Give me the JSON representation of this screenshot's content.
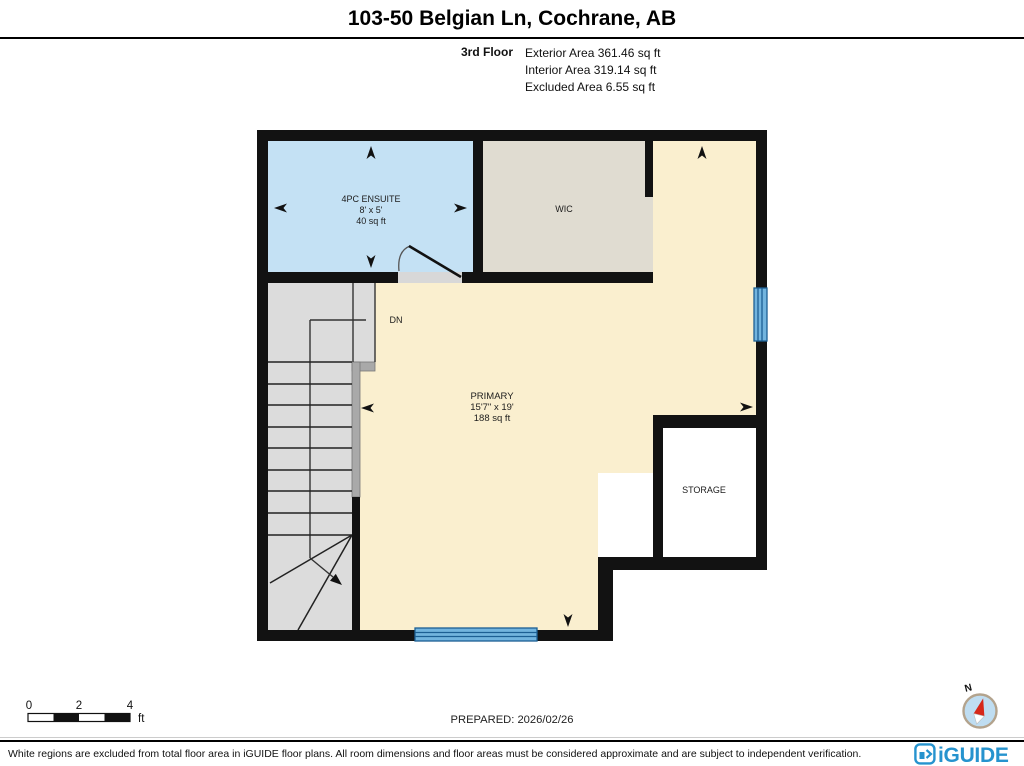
{
  "header": {
    "title": "103-50 Belgian Ln, Cochrane, AB",
    "floor_label": "3rd Floor",
    "exterior_area": "Exterior Area 361.46 sq ft",
    "interior_area": "Interior Area 319.14 sq ft",
    "excluded_area": "Excluded Area 6.55 sq ft"
  },
  "rooms": {
    "ensuite": {
      "name": "4PC ENSUITE",
      "dims": "8' x 5'",
      "area": "40 sq ft"
    },
    "wic": {
      "name": "WIC"
    },
    "primary": {
      "name": "PRIMARY",
      "dims": "15'7\" x 19'",
      "area": "188 sq ft"
    },
    "storage": {
      "name": "STORAGE"
    },
    "stairs": {
      "direction_label": "DN"
    }
  },
  "scale_bar": {
    "tick0": "0",
    "tick2": "2",
    "tick4": "4",
    "unit": "ft"
  },
  "prepared_label": "PREPARED: 2026/02/26",
  "compass": {
    "north_label": "N"
  },
  "footer": {
    "disclaimer": "White regions are excluded from total floor area in iGUIDE floor plans. All room dimensions and floor areas must be considered approximate and are subject to independent verification.",
    "brand": "iGUIDE"
  },
  "colors": {
    "ensuite_fill": "#c4e1f4",
    "wic_fill": "#e0dcd1",
    "primary_fill": "#faefcf",
    "stairs_fill": "#dcdcdc",
    "rail_fill": "#a9a9a9",
    "window_fill": "#72b4de",
    "window_line": "#1c5f93",
    "brand_blue": "#2693ce",
    "compass_red": "#d6281a",
    "compass_blue": "#bfddf1"
  }
}
